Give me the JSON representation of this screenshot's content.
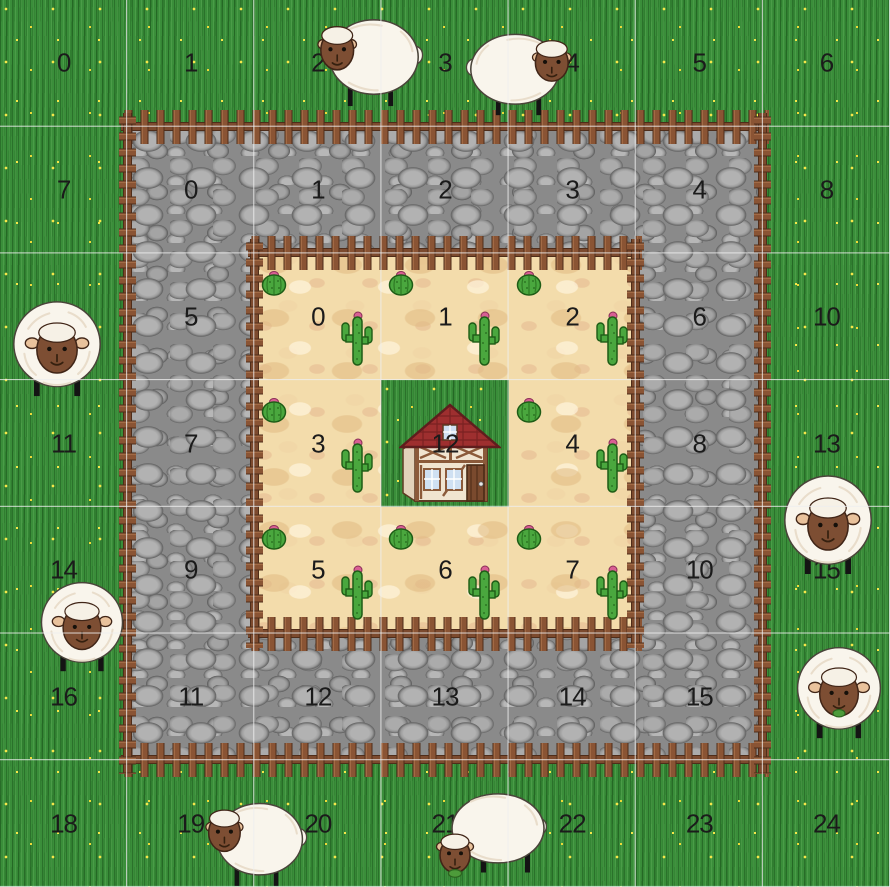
{
  "scene": {
    "title": "sheep-pasture-grid-world",
    "grid": {
      "cols": 7,
      "rows": 7,
      "width_px": 890,
      "height_px": 887
    },
    "regions": [
      {
        "id": "grass-field",
        "texture": "grass",
        "c": 0,
        "r": 0,
        "cols": 7,
        "rows": 7
      },
      {
        "id": "stone-ring",
        "texture": "stone",
        "c": 1,
        "r": 1,
        "cols": 5,
        "rows": 5
      },
      {
        "id": "sand-ring",
        "texture": "sand",
        "c": 2,
        "r": 2,
        "cols": 3,
        "rows": 3
      },
      {
        "id": "center-grass-tile",
        "texture": "grass",
        "c": 3,
        "r": 3,
        "cols": 1,
        "rows": 1
      }
    ],
    "fences": [
      {
        "id": "stone-fence-top",
        "dir": "h",
        "c": 1,
        "r": 1,
        "len": 5
      },
      {
        "id": "stone-fence-bottom",
        "dir": "h",
        "c": 1,
        "r": 6,
        "len": 5
      },
      {
        "id": "stone-fence-left",
        "dir": "v",
        "c": 1,
        "r": 1,
        "len": 5
      },
      {
        "id": "stone-fence-right",
        "dir": "v",
        "c": 6,
        "r": 1,
        "len": 5
      },
      {
        "id": "sand-fence-top",
        "dir": "h",
        "c": 2,
        "r": 2,
        "len": 3
      },
      {
        "id": "sand-fence-bottom",
        "dir": "h",
        "c": 2,
        "r": 5,
        "len": 3
      },
      {
        "id": "sand-fence-left",
        "dir": "v",
        "c": 2,
        "r": 2,
        "len": 3
      },
      {
        "id": "sand-fence-right",
        "dir": "v",
        "c": 5,
        "r": 2,
        "len": 3
      }
    ],
    "labels": [
      {
        "layer": "grass",
        "text": "0",
        "c": 0,
        "r": 0
      },
      {
        "layer": "grass",
        "text": "1",
        "c": 1,
        "r": 0
      },
      {
        "layer": "grass",
        "text": "2",
        "c": 2,
        "r": 0
      },
      {
        "layer": "grass",
        "text": "3",
        "c": 3,
        "r": 0
      },
      {
        "layer": "grass",
        "text": "4",
        "c": 4,
        "r": 0
      },
      {
        "layer": "grass",
        "text": "5",
        "c": 5,
        "r": 0
      },
      {
        "layer": "grass",
        "text": "6",
        "c": 6,
        "r": 0
      },
      {
        "layer": "grass",
        "text": "7",
        "c": 0,
        "r": 1
      },
      {
        "layer": "grass",
        "text": "8",
        "c": 6,
        "r": 1
      },
      {
        "layer": "grass",
        "text": "9",
        "c": 0,
        "r": 2
      },
      {
        "layer": "grass",
        "text": "10",
        "c": 6,
        "r": 2
      },
      {
        "layer": "grass",
        "text": "11",
        "c": 0,
        "r": 3
      },
      {
        "layer": "grass",
        "text": "12",
        "c": 3,
        "r": 3
      },
      {
        "layer": "grass",
        "text": "13",
        "c": 6,
        "r": 3
      },
      {
        "layer": "grass",
        "text": "14",
        "c": 0,
        "r": 4
      },
      {
        "layer": "grass",
        "text": "15",
        "c": 6,
        "r": 4
      },
      {
        "layer": "grass",
        "text": "16",
        "c": 0,
        "r": 5
      },
      {
        "layer": "grass",
        "text": "17",
        "c": 6,
        "r": 5
      },
      {
        "layer": "grass",
        "text": "18",
        "c": 0,
        "r": 6
      },
      {
        "layer": "grass",
        "text": "19",
        "c": 1,
        "r": 6
      },
      {
        "layer": "grass",
        "text": "20",
        "c": 2,
        "r": 6
      },
      {
        "layer": "grass",
        "text": "21",
        "c": 3,
        "r": 6
      },
      {
        "layer": "grass",
        "text": "22",
        "c": 4,
        "r": 6
      },
      {
        "layer": "grass",
        "text": "23",
        "c": 5,
        "r": 6
      },
      {
        "layer": "grass",
        "text": "24",
        "c": 6,
        "r": 6
      },
      {
        "layer": "stone",
        "text": "0",
        "c": 1,
        "r": 1
      },
      {
        "layer": "stone",
        "text": "1",
        "c": 2,
        "r": 1
      },
      {
        "layer": "stone",
        "text": "2",
        "c": 3,
        "r": 1
      },
      {
        "layer": "stone",
        "text": "3",
        "c": 4,
        "r": 1
      },
      {
        "layer": "stone",
        "text": "4",
        "c": 5,
        "r": 1
      },
      {
        "layer": "stone",
        "text": "5",
        "c": 1,
        "r": 2
      },
      {
        "layer": "stone",
        "text": "6",
        "c": 5,
        "r": 2
      },
      {
        "layer": "stone",
        "text": "7",
        "c": 1,
        "r": 3
      },
      {
        "layer": "stone",
        "text": "8",
        "c": 5,
        "r": 3
      },
      {
        "layer": "stone",
        "text": "9",
        "c": 1,
        "r": 4
      },
      {
        "layer": "stone",
        "text": "10",
        "c": 5,
        "r": 4
      },
      {
        "layer": "stone",
        "text": "11",
        "c": 1,
        "r": 5
      },
      {
        "layer": "stone",
        "text": "12",
        "c": 2,
        "r": 5
      },
      {
        "layer": "stone",
        "text": "13",
        "c": 3,
        "r": 5
      },
      {
        "layer": "stone",
        "text": "14",
        "c": 4,
        "r": 5
      },
      {
        "layer": "stone",
        "text": "15",
        "c": 5,
        "r": 5
      },
      {
        "layer": "sand",
        "text": "0",
        "c": 2,
        "r": 2
      },
      {
        "layer": "sand",
        "text": "1",
        "c": 3,
        "r": 2
      },
      {
        "layer": "sand",
        "text": "2",
        "c": 4,
        "r": 2
      },
      {
        "layer": "sand",
        "text": "3",
        "c": 2,
        "r": 3
      },
      {
        "layer": "sand",
        "text": "4",
        "c": 4,
        "r": 3
      },
      {
        "layer": "sand",
        "text": "5",
        "c": 2,
        "r": 4
      },
      {
        "layer": "sand",
        "text": "6",
        "c": 3,
        "r": 4
      },
      {
        "layer": "sand",
        "text": "7",
        "c": 4,
        "r": 4
      }
    ],
    "house": {
      "id": "house",
      "x": 450,
      "y": 452,
      "w": 102,
      "h": 106
    },
    "cacti": [
      {
        "type": "barrel",
        "x": 274,
        "y": 283
      },
      {
        "type": "barrel",
        "x": 401,
        "y": 283
      },
      {
        "type": "barrel",
        "x": 529,
        "y": 283
      },
      {
        "type": "saguaro",
        "x": 357,
        "y": 340
      },
      {
        "type": "saguaro",
        "x": 484,
        "y": 340
      },
      {
        "type": "saguaro",
        "x": 612,
        "y": 340
      },
      {
        "type": "barrel",
        "x": 274,
        "y": 410
      },
      {
        "type": "barrel",
        "x": 529,
        "y": 410
      },
      {
        "type": "saguaro",
        "x": 357,
        "y": 467
      },
      {
        "type": "saguaro",
        "x": 612,
        "y": 467
      },
      {
        "type": "barrel",
        "x": 274,
        "y": 537
      },
      {
        "type": "barrel",
        "x": 401,
        "y": 537
      },
      {
        "type": "barrel",
        "x": 529,
        "y": 537
      },
      {
        "type": "saguaro",
        "x": 357,
        "y": 594
      },
      {
        "type": "saguaro",
        "x": 484,
        "y": 594
      },
      {
        "type": "saguaro",
        "x": 612,
        "y": 594
      }
    ],
    "sheep": [
      {
        "id": "sheep-1",
        "pose": "side",
        "facing": "left",
        "eating": false,
        "x": 370,
        "y": 60,
        "w": 108,
        "h": 96
      },
      {
        "id": "sheep-2",
        "pose": "side",
        "facing": "right",
        "eating": false,
        "x": 519,
        "y": 72,
        "w": 108,
        "h": 90
      },
      {
        "id": "sheep-3",
        "pose": "front",
        "facing": "front",
        "eating": false,
        "x": 57,
        "y": 348,
        "w": 96,
        "h": 100
      },
      {
        "id": "sheep-4",
        "pose": "front",
        "facing": "front",
        "eating": false,
        "x": 828,
        "y": 524,
        "w": 96,
        "h": 104
      },
      {
        "id": "sheep-5",
        "pose": "front",
        "facing": "front",
        "eating": false,
        "x": 82,
        "y": 626,
        "w": 90,
        "h": 94
      },
      {
        "id": "sheep-6",
        "pose": "front",
        "facing": "front",
        "eating": true,
        "x": 839,
        "y": 692,
        "w": 92,
        "h": 96
      },
      {
        "id": "sheep-7",
        "pose": "side",
        "facing": "left",
        "eating": false,
        "x": 256,
        "y": 842,
        "w": 104,
        "h": 92
      },
      {
        "id": "sheep-8",
        "pose": "grazing",
        "facing": "left",
        "eating": true,
        "x": 491,
        "y": 838,
        "w": 112,
        "h": 92
      }
    ]
  },
  "palette": {
    "grass": "#3a8e3a",
    "grass_dark": "#1b581b",
    "grass_light": "#85cf78",
    "flower_yellow": "#f6e74a",
    "stone_base": "#8a8a8a",
    "stone_light": "#b2b2b2",
    "stone_dark": "#646464",
    "sand_base": "#f3dcab",
    "sand_dark": "#e0ba82",
    "sand_light": "#fff4dd",
    "fence_mid": "#8a5434",
    "fence_light": "#a26a45",
    "fence_dark": "#4f2d1a",
    "fence_rail": "#7c4a2e",
    "grid_line": "#eeeeee",
    "label": "#1b1b1b",
    "wool": "#f9f5ec",
    "wool_shade": "#e9ddcb",
    "wool_cap": "#f6f1e6",
    "wool_outline": "#4a443a",
    "face": "#7d4e33",
    "face_outline": "#402517",
    "ear": "#e9c29c",
    "leg": "#141414",
    "grass_tuft": "#4d9b3a",
    "roof_red": "#9e2f2f",
    "roof_line": "#7a2222",
    "roof_edge": "#5f1d1d",
    "wall_cream": "#f0e4d0",
    "wall_side": "#e2d2ba",
    "timber": "#8b5a3a",
    "timber_dark": "#5c3a22",
    "door": "#7a4a2e",
    "door_dark": "#4a2b16",
    "window_blue": "#cfe0f2",
    "cactus_green": "#4aa73e",
    "cactus_dark": "#1e5c16",
    "cactus_line": "#2e7a24",
    "cactus_flower": "#d95f93"
  },
  "icon_names": [
    "sheep-side-icon",
    "sheep-front-icon",
    "sheep-grazing-icon",
    "barrel-cactus-icon",
    "saguaro-cactus-icon",
    "house-icon",
    "picket-fence"
  ]
}
